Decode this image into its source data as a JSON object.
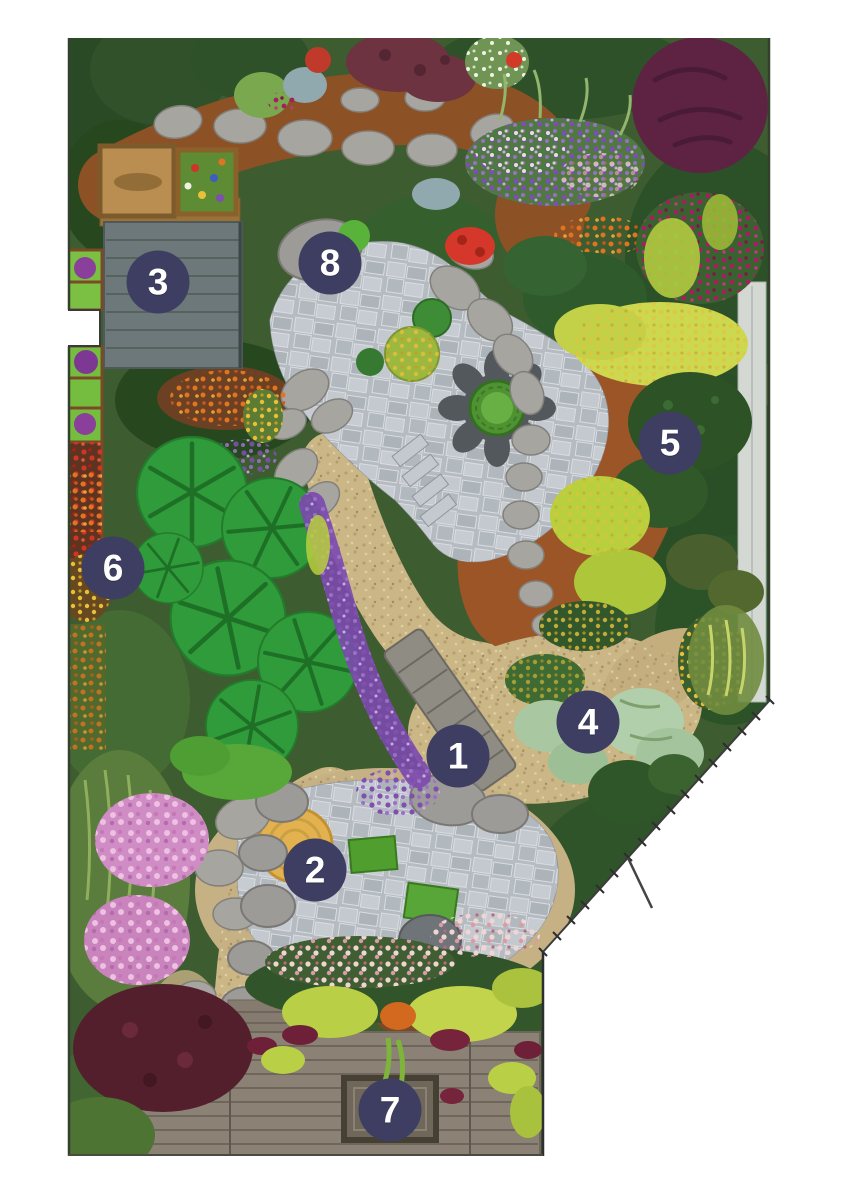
{
  "page": {
    "background": "#ffffff"
  },
  "illustration": {
    "type": "garden-plan-illustration",
    "markers": [
      {
        "number": "1",
        "x": 458,
        "y": 756
      },
      {
        "number": "2",
        "x": 315,
        "y": 870
      },
      {
        "number": "3",
        "x": 158,
        "y": 282
      },
      {
        "number": "4",
        "x": 588,
        "y": 722
      },
      {
        "number": "5",
        "x": 670,
        "y": 443
      },
      {
        "number": "6",
        "x": 113,
        "y": 568
      },
      {
        "number": "7",
        "x": 390,
        "y": 1110
      },
      {
        "number": "8",
        "x": 330,
        "y": 263
      }
    ],
    "marker_style": {
      "fill": "#3e3e63",
      "text_color": "#ffffff",
      "diameter": 63
    },
    "palette": {
      "foliage_green": "#3d5c30",
      "dark_green": "#2a4a25",
      "mulch_brown": "#8d5126",
      "terracotta": "#9c5527",
      "gravel_tan": "#cbb686",
      "flagstone_gray": "#b6bbc1",
      "deck_gray": "#6d787b",
      "lower_deck": "#8b8174",
      "wood": "#b98e50",
      "chartreuse": "#c2d44c",
      "purple": "#7e4fae",
      "pink": "#d08cc4",
      "maroon": "#5e2343"
    }
  }
}
